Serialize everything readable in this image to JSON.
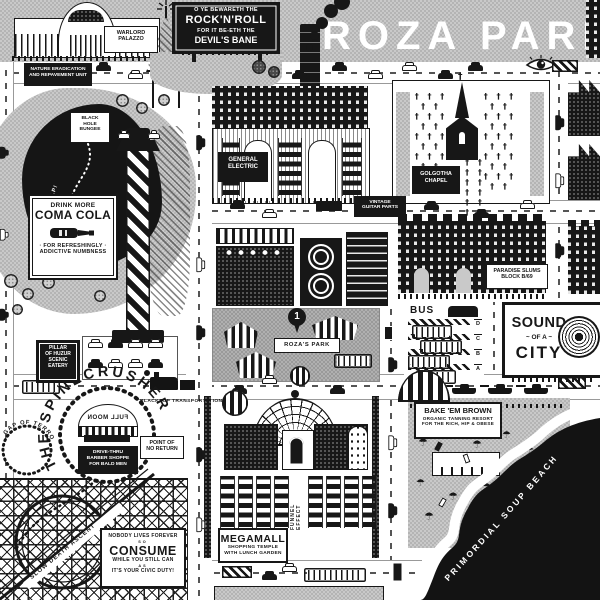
{
  "title": "ROZA PARKS",
  "colors": {
    "ink": "#171717",
    "band_gray": "#c9c9c9",
    "park_gray": "#b0b0b0",
    "white": "#ffffff"
  },
  "billboards": {
    "rock": {
      "line1": "O YE BEWARETH THE",
      "line2": "ROCK'N'ROLL",
      "line3": "FOR IT BE-ETH THE",
      "line4": "DEVIL'S BANE"
    },
    "coma_cola": {
      "line1": "DRINK MORE",
      "line2": "COMA COLA",
      "line3": "· FOR REFRESHINGLY ·",
      "line4": "ADDICTIVE NUMBNESS"
    },
    "sound": {
      "line1": "SOUND",
      "line2": "~ OF A ~",
      "line3": "CITY"
    },
    "consume": {
      "line1": "NOBODY LIVES FOREVER",
      "line2": "SO",
      "line3": "CONSUME",
      "line4": "WHILE YOU STILL CAN",
      "line5": "AS",
      "line6": "IT'S YOUR CIVIC DUTY!"
    }
  },
  "places": {
    "warlord": {
      "line1": "WARLORD",
      "line2": "PALAZZO"
    },
    "nature": {
      "line1": "NATURE ERADICATION",
      "line2": "AND REPAVEMENT UNIT"
    },
    "black_hole": {
      "line1": "BLACK",
      "line2": "HOLE",
      "line3": "BUNGEE"
    },
    "help": "HELP!",
    "pillar": {
      "line1": "PILLAR",
      "line2": "OF HUZUR",
      "line3": "SCENIC",
      "line4": "EATERY"
    },
    "general_electric": {
      "line1": "GENERAL",
      "line2": "ELECTRIC"
    },
    "golgotha": {
      "line1": "GOLGOTHA",
      "line2": "CHAPEL"
    },
    "vintage": {
      "line1": "VINTAGE",
      "line2": "GUITAR PARTS"
    },
    "paradise": {
      "line1": "PARADISE SLUMS",
      "line2": "BLOCK B/69"
    },
    "rozas_park": {
      "label": "ROZA'S PARK",
      "pin": "1"
    },
    "bus": {
      "title": "BUS",
      "platform_d": "D",
      "platform_c": "C",
      "platform_b": "B",
      "platform_a": "A"
    },
    "spinecrusher": "THE SPINECRUSHER",
    "gap_of_terror": "GAP OF TERROR",
    "full_moon": "FULL MOON",
    "barber": {
      "line1": "DRIVE-THRU",
      "line2": "BARBER SHOPPE",
      "line3": "FOR BALD MEN"
    },
    "point_of_no_return": {
      "line1": "POINT OF",
      "line2": "NO RETURN"
    },
    "blacktop": "BLACKTOP TRANSPORTATION",
    "slow_death": "SLOW DEATH ASCENT",
    "megamall": {
      "line1": "MEGAMALL",
      "line2": "SHOPPING TEMPLE",
      "line3": "WITH LUNCH GARDEN"
    },
    "funnel": "FUNNEL EFFECT",
    "bake": {
      "line1": "BAKE 'EM BROWN",
      "line2": "ORGANIC TANNING RESORT",
      "line3": "FOR THE RICH, HIP & OBESE"
    },
    "soup": "PRIMORDIAL SOUP BEACH"
  },
  "glyphs": {
    "cross_field": "† † † † †\n† † † † †\n† † † † †\n† † † † †\n† † † † †",
    "cross_field_small": "† † † †\n† † † †\n† † † †",
    "cross": "†",
    "umbrella": "☂"
  }
}
